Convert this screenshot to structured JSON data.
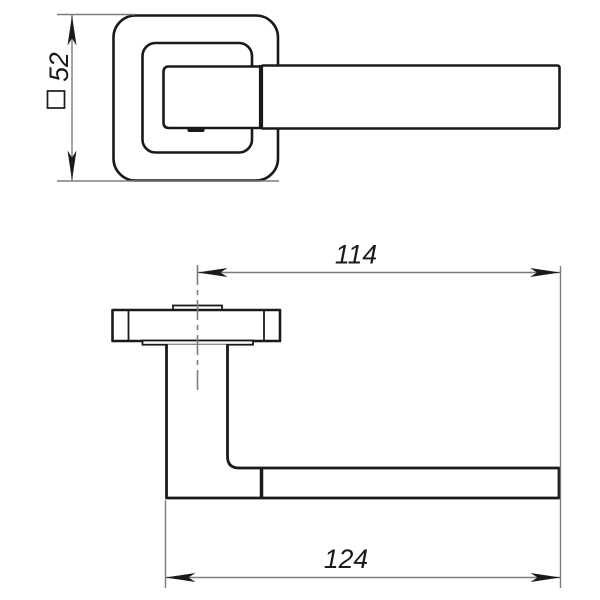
{
  "drawing": {
    "kind": "technical-drawing",
    "subject": "door-lever-handle-on-square-rosette",
    "colors": {
      "background": "#ffffff",
      "outline": "#1a1a1a",
      "dimension_lines": "#7d7d7d",
      "text": "#1a1a1a"
    },
    "views": [
      {
        "id": "front-view"
      },
      {
        "id": "side-view"
      }
    ],
    "dims": {
      "rosette": {
        "symbol": "□",
        "value": "52"
      },
      "lever_from_center": {
        "value": "114"
      },
      "overall_length": {
        "value": "124"
      }
    }
  }
}
